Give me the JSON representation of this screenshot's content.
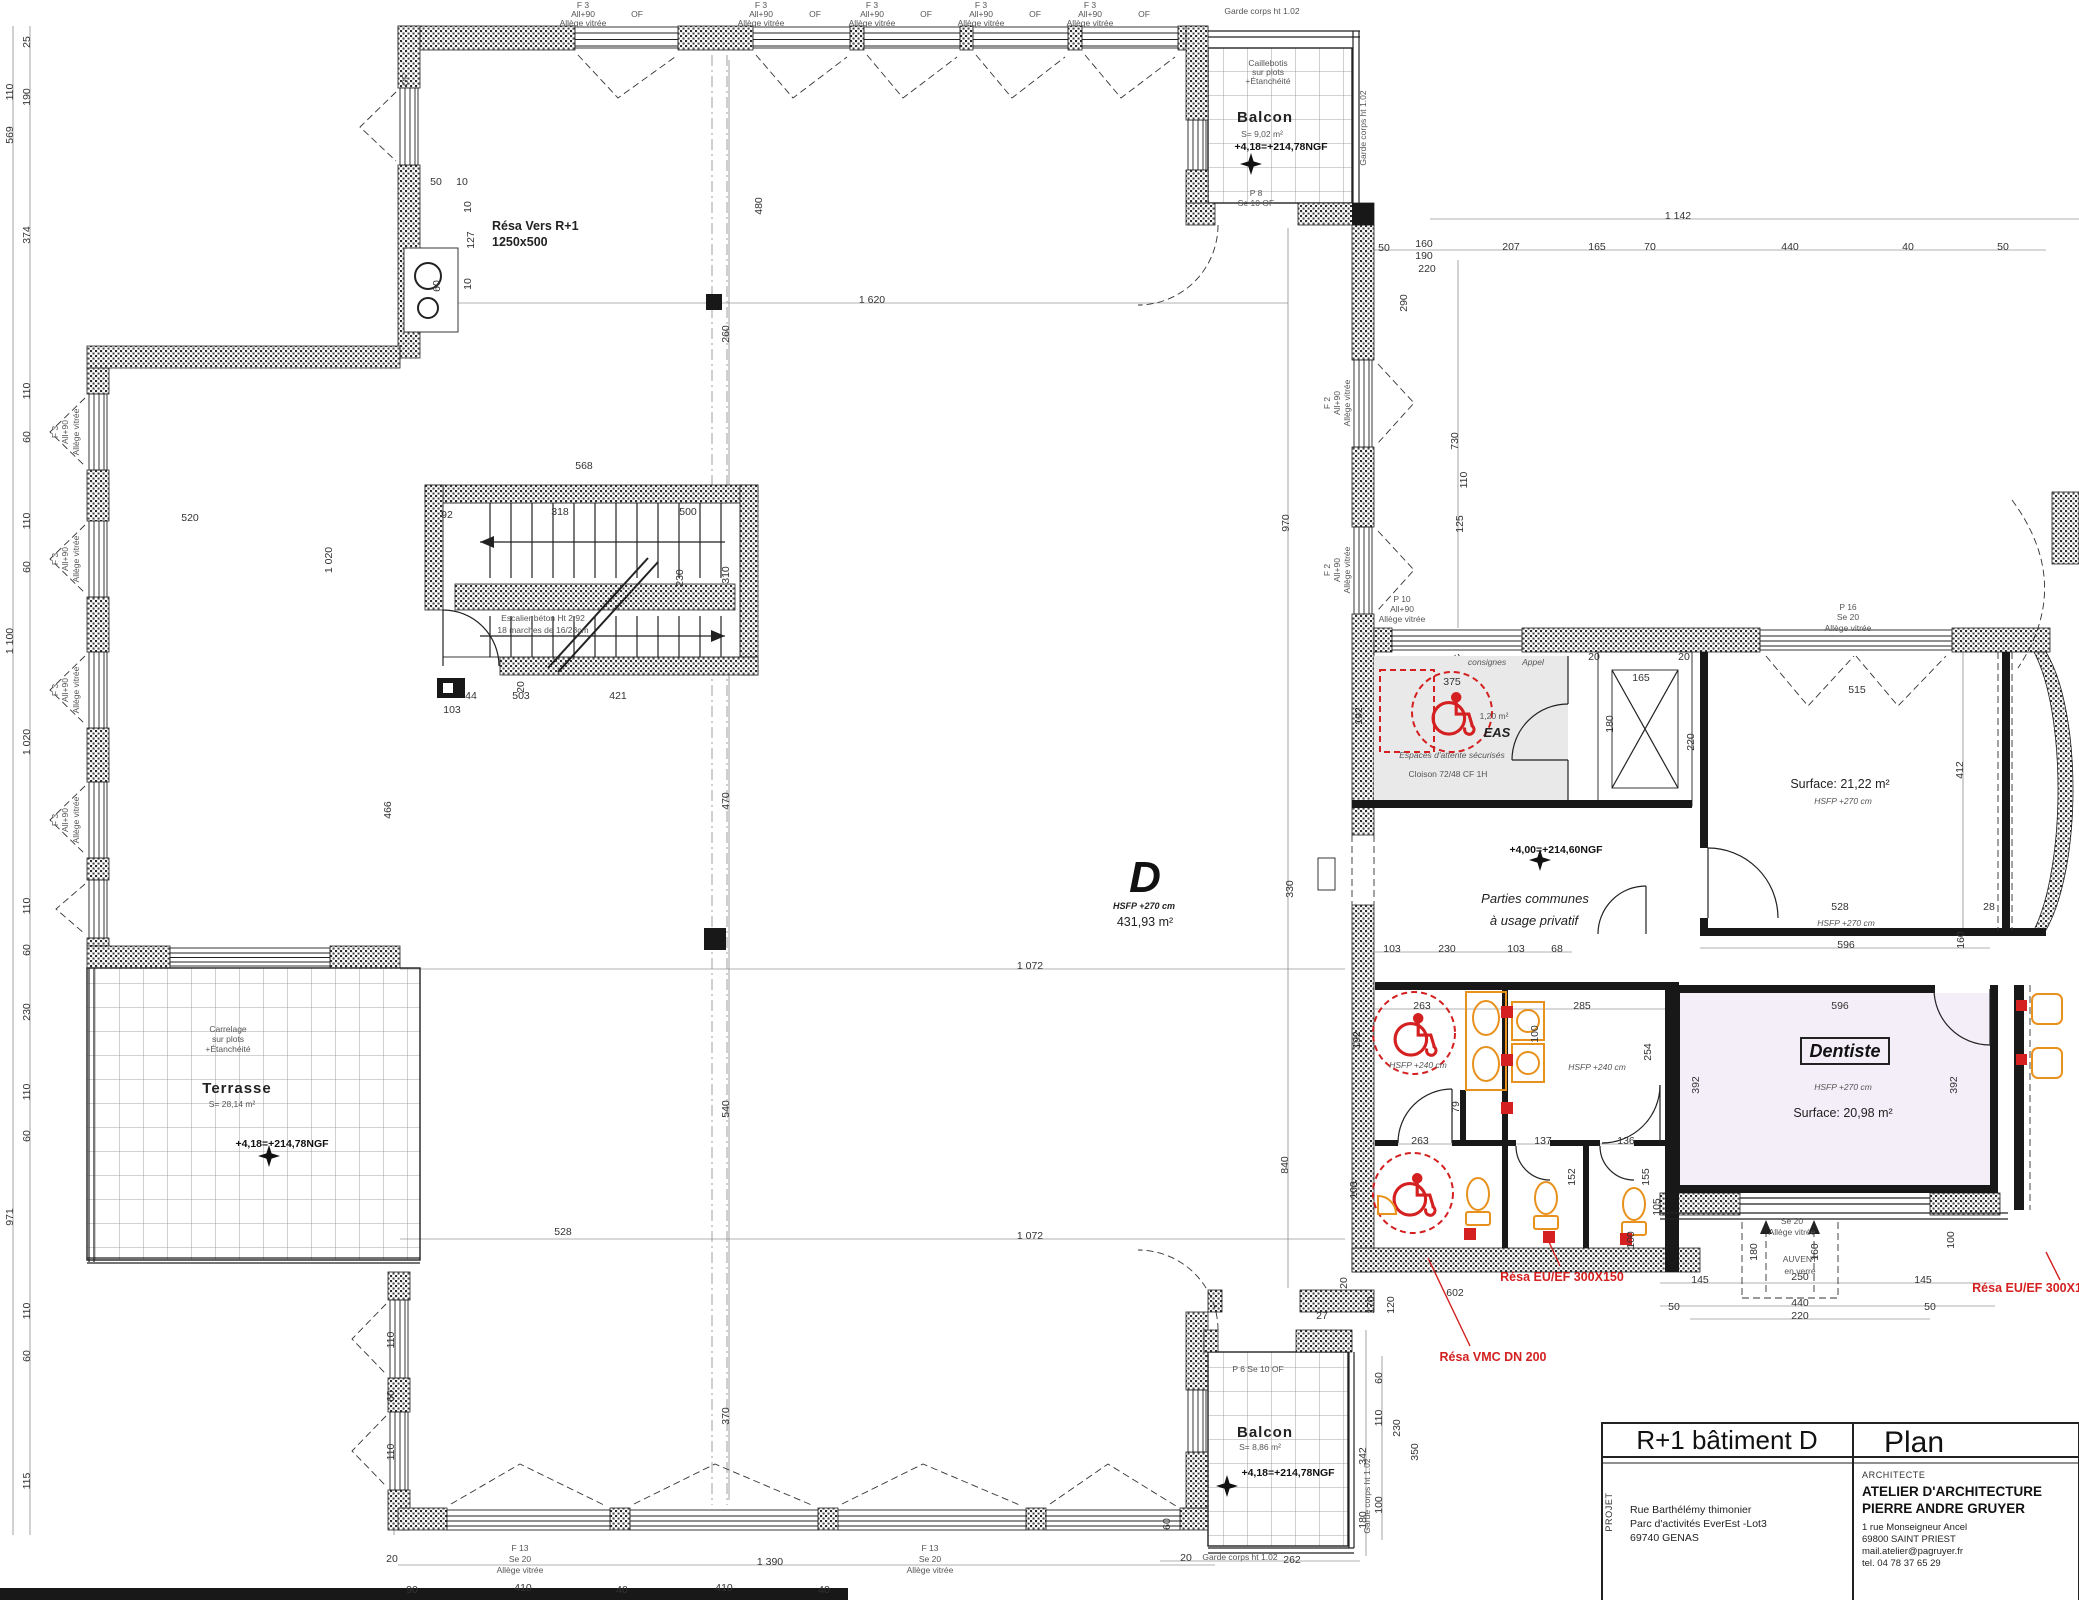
{
  "colors": {
    "red": "#d42020",
    "orange": "#e8921d",
    "dentiste_fill": "#f4eef8",
    "grey_fill": "#e9e9e9",
    "wall": "#181818"
  },
  "title_block": {
    "sheet_title": "R+1 bâtiment D",
    "sheet_type": "Plan",
    "projet_label": "PROJET",
    "projet_line1": "Rue Barthélémy thimonier",
    "projet_line2": "Parc d'activités EverEst -Lot3",
    "projet_line3": "69740 GENAS",
    "architecte_label": "ARCHITECTE",
    "architecte_name1": "ATELIER D'ARCHITECTURE",
    "architecte_name2": "PIERRE ANDRE GRUYER",
    "arch_line1": "1 rue Monseigneur Ancel",
    "arch_line2": "69800 SAINT PRIEST",
    "arch_line3": "mail.atelier@pagruyer.fr",
    "arch_line4": "tel. 04 78 37 65 29"
  },
  "plan": {
    "hall": {
      "letter": "D",
      "hsfp": "HSFP +270 cm",
      "area": "431,93 m²"
    },
    "parties1": "Parties communes",
    "parties2": "à usage privatif",
    "levels": {
      "main": "+4,00=+214,60NGF",
      "balcon_top": "+4,18=+214,78NGF",
      "balcon_bottom": "+4,18=+214,78NGF",
      "terrasse": "+4,18=+214,78NGF"
    },
    "rooms": {
      "dentiste": {
        "name": "Dentiste",
        "hsfp": "HSFP +270 cm",
        "surface": "Surface: 20,98 m²"
      },
      "s2122": {
        "surface": "Surface: 21,22 m²",
        "hsfp": "HSFP +270 cm"
      },
      "eas": {
        "name": "EAS",
        "area": "1,20 m²",
        "note": "Espaces d'attente sécurisés",
        "cloison": "Cloison 72/48 CF 1H",
        "consignes": "consignes",
        "appel": "Appel"
      },
      "balcon_top": {
        "name": "Balcon",
        "area": "S= 9,02 m²"
      },
      "balcon_bottom": {
        "name": "Balcon",
        "area": "S= 8,86 m²"
      },
      "terrasse": {
        "name": "Terrasse",
        "area": "S= 28,14 m²"
      }
    },
    "stair": {
      "line1": "Escalier béton Ht 2,92",
      "line2": "18 marches de 16/28cm"
    },
    "res": {
      "vers1": "Résa Vers R+1",
      "vers2": "1250x500",
      "eu_ef": "Résa EU/EF 300X150",
      "vmc": "Résa VMC DN 200",
      "eu_right": "Résa EU/EF 300X150"
    }
  },
  "annotations": [
    {
      "t": "1 620",
      "x": 872,
      "y": 303
    },
    {
      "t": "1 142",
      "x": 1678,
      "y": 219
    },
    {
      "t": "50",
      "x": 1384,
      "y": 251
    },
    {
      "t": "160",
      "x": 1424,
      "y": 247
    },
    {
      "t": "190",
      "x": 1424,
      "y": 259
    },
    {
      "t": "220",
      "x": 1427,
      "y": 272
    },
    {
      "t": "207",
      "x": 1511,
      "y": 250
    },
    {
      "t": "165",
      "x": 1597,
      "y": 250
    },
    {
      "t": "70",
      "x": 1650,
      "y": 250
    },
    {
      "t": "440",
      "x": 1790,
      "y": 250
    },
    {
      "t": "40",
      "x": 1908,
      "y": 250
    },
    {
      "t": "50",
      "x": 2003,
      "y": 250
    },
    {
      "t": "290",
      "x": 1407,
      "y": 303,
      "r": -90
    },
    {
      "t": "730",
      "x": 1458,
      "y": 441,
      "r": -90
    },
    {
      "t": "125",
      "x": 1463,
      "y": 524,
      "r": -90
    },
    {
      "t": "110",
      "x": 1467,
      "y": 480,
      "r": -90
    },
    {
      "t": "970",
      "x": 1289,
      "y": 523,
      "r": -90
    },
    {
      "t": "330",
      "x": 1293,
      "y": 889,
      "r": -90
    },
    {
      "t": "840",
      "x": 1288,
      "y": 1165,
      "r": -90
    },
    {
      "t": "480",
      "x": 762,
      "y": 206,
      "r": -90
    },
    {
      "t": "260",
      "x": 729,
      "y": 334,
      "r": -90
    },
    {
      "t": "310",
      "x": 729,
      "y": 575,
      "r": -90
    },
    {
      "t": "470",
      "x": 729,
      "y": 801,
      "r": -90
    },
    {
      "t": "540",
      "x": 729,
      "y": 1109,
      "r": -90
    },
    {
      "t": "370",
      "x": 729,
      "y": 1416,
      "r": -90
    },
    {
      "t": "1 072",
      "x": 1030,
      "y": 969
    },
    {
      "t": "1 072",
      "x": 1030,
      "y": 1239
    },
    {
      "t": "528",
      "x": 563,
      "y": 1235
    },
    {
      "t": "568",
      "x": 584,
      "y": 469
    },
    {
      "t": "92",
      "x": 447,
      "y": 518
    },
    {
      "t": "318",
      "x": 560,
      "y": 515
    },
    {
      "t": "500",
      "x": 688,
      "y": 515
    },
    {
      "t": "230",
      "x": 683,
      "y": 578,
      "r": -90
    },
    {
      "t": "20",
      "x": 524,
      "y": 687,
      "r": -90
    },
    {
      "t": "44",
      "x": 471,
      "y": 699
    },
    {
      "t": "503",
      "x": 521,
      "y": 699
    },
    {
      "t": "421",
      "x": 618,
      "y": 699
    },
    {
      "t": "103",
      "x": 452,
      "y": 713
    },
    {
      "t": "520",
      "x": 190,
      "y": 521
    },
    {
      "t": "1 020",
      "x": 332,
      "y": 560,
      "r": -90
    },
    {
      "t": "466",
      "x": 391,
      "y": 810,
      "r": -90
    },
    {
      "t": "50",
      "x": 436,
      "y": 185
    },
    {
      "t": "10",
      "x": 462,
      "y": 185
    },
    {
      "t": "127",
      "x": 474,
      "y": 240,
      "r": -90
    },
    {
      "t": "10",
      "x": 471,
      "y": 207,
      "r": -90
    },
    {
      "t": "10",
      "x": 471,
      "y": 284,
      "r": -90
    },
    {
      "t": "60",
      "x": 440,
      "y": 286,
      "r": -90
    },
    {
      "t": "25",
      "x": 30,
      "y": 42,
      "r": -90
    },
    {
      "t": "110",
      "x": 13,
      "y": 92,
      "r": -90
    },
    {
      "t": "190",
      "x": 30,
      "y": 97,
      "r": -90
    },
    {
      "t": "569",
      "x": 13,
      "y": 135,
      "r": -90
    },
    {
      "t": "374",
      "x": 30,
      "y": 235,
      "r": -90
    },
    {
      "t": "110",
      "x": 30,
      "y": 391,
      "r": -90
    },
    {
      "t": "60",
      "x": 30,
      "y": 437,
      "r": -90
    },
    {
      "t": "110",
      "x": 30,
      "y": 521,
      "r": -90
    },
    {
      "t": "60",
      "x": 30,
      "y": 567,
      "r": -90
    },
    {
      "t": "1 100",
      "x": 13,
      "y": 641,
      "r": -90
    },
    {
      "t": "1 020",
      "x": 30,
      "y": 742,
      "r": -90
    },
    {
      "t": "110",
      "x": 30,
      "y": 906,
      "r": -90
    },
    {
      "t": "60",
      "x": 30,
      "y": 950,
      "r": -90
    },
    {
      "t": "230",
      "x": 30,
      "y": 1012,
      "r": -90
    },
    {
      "t": "110",
      "x": 30,
      "y": 1092,
      "r": -90
    },
    {
      "t": "60",
      "x": 30,
      "y": 1136,
      "r": -90
    },
    {
      "t": "971",
      "x": 13,
      "y": 1217,
      "r": -90
    },
    {
      "t": "110",
      "x": 30,
      "y": 1311,
      "r": -90
    },
    {
      "t": "60",
      "x": 30,
      "y": 1356,
      "r": -90
    },
    {
      "t": "115",
      "x": 30,
      "y": 1481,
      "r": -90
    },
    {
      "t": "103",
      "x": 1392,
      "y": 952
    },
    {
      "t": "230",
      "x": 1447,
      "y": 952
    },
    {
      "t": "103",
      "x": 1516,
      "y": 952
    },
    {
      "t": "68",
      "x": 1557,
      "y": 952
    },
    {
      "t": "375",
      "x": 1452,
      "y": 685
    },
    {
      "t": "165",
      "x": 1641,
      "y": 681
    },
    {
      "t": "180",
      "x": 1613,
      "y": 724,
      "r": -90
    },
    {
      "t": "20",
      "x": 1594,
      "y": 660
    },
    {
      "t": "20",
      "x": 1684,
      "y": 660
    },
    {
      "t": "515",
      "x": 1857,
      "y": 693
    },
    {
      "t": "412",
      "x": 1963,
      "y": 770,
      "r": -90
    },
    {
      "t": "220",
      "x": 1694,
      "y": 742,
      "r": -90
    },
    {
      "t": "528",
      "x": 1840,
      "y": 910
    },
    {
      "t": "28",
      "x": 1989,
      "y": 910
    },
    {
      "t": "HSFP +270 cm",
      "x": 1846,
      "y": 926,
      "c": "tinyi"
    },
    {
      "t": "596",
      "x": 1846,
      "y": 948
    },
    {
      "t": "160",
      "x": 1964,
      "y": 940,
      "r": -90
    },
    {
      "t": "596",
      "x": 1840,
      "y": 1009
    },
    {
      "t": "392",
      "x": 1699,
      "y": 1085,
      "r": -90
    },
    {
      "t": "392",
      "x": 1957,
      "y": 1085,
      "r": -90
    },
    {
      "t": "263",
      "x": 1422,
      "y": 1009
    },
    {
      "t": "285",
      "x": 1582,
      "y": 1009
    },
    {
      "t": "263",
      "x": 1420,
      "y": 1144
    },
    {
      "t": "137",
      "x": 1543,
      "y": 1144
    },
    {
      "t": "136",
      "x": 1626,
      "y": 1144
    },
    {
      "t": "79",
      "x": 1459,
      "y": 1107,
      "r": -90
    },
    {
      "t": "100",
      "x": 1538,
      "y": 1034,
      "r": -90
    },
    {
      "t": "152",
      "x": 1575,
      "y": 1177,
      "r": -90
    },
    {
      "t": "155",
      "x": 1649,
      "y": 1177,
      "r": -90
    },
    {
      "t": "105",
      "x": 1660,
      "y": 1207,
      "r": -90
    },
    {
      "t": "100",
      "x": 1357,
      "y": 1190,
      "r": -90
    },
    {
      "t": "192",
      "x": 1360,
      "y": 1040,
      "r": -90
    },
    {
      "t": "192",
      "x": 1362,
      "y": 716,
      "r": -90
    },
    {
      "t": "254",
      "x": 1651,
      "y": 1052,
      "r": -90
    },
    {
      "t": "602",
      "x": 1455,
      "y": 1296
    },
    {
      "t": "170",
      "x": 1374,
      "y": 1305,
      "r": -90
    },
    {
      "t": "120",
      "x": 1394,
      "y": 1305,
      "r": -90
    },
    {
      "t": "20",
      "x": 1347,
      "y": 1283,
      "r": -90
    },
    {
      "t": "27",
      "x": 1322,
      "y": 1319
    },
    {
      "t": "145",
      "x": 1700,
      "y": 1283
    },
    {
      "t": "250",
      "x": 1800,
      "y": 1280
    },
    {
      "t": "145",
      "x": 1923,
      "y": 1283
    },
    {
      "t": "50",
      "x": 1674,
      "y": 1310
    },
    {
      "t": "440",
      "x": 1800,
      "y": 1306
    },
    {
      "t": "50",
      "x": 1930,
      "y": 1310
    },
    {
      "t": "220",
      "x": 1800,
      "y": 1319
    },
    {
      "t": "100",
      "x": 1634,
      "y": 1240,
      "r": -90
    },
    {
      "t": "100",
      "x": 1954,
      "y": 1240,
      "r": -90
    },
    {
      "t": "180",
      "x": 1757,
      "y": 1252,
      "r": -90
    },
    {
      "t": "160",
      "x": 1818,
      "y": 1252,
      "r": -90
    },
    {
      "t": "60",
      "x": 1382,
      "y": 1378,
      "r": -90
    },
    {
      "t": "110",
      "x": 1382,
      "y": 1418,
      "r": -90
    },
    {
      "t": "230",
      "x": 1400,
      "y": 1428,
      "r": -90
    },
    {
      "t": "342",
      "x": 1366,
      "y": 1456,
      "r": -90
    },
    {
      "t": "350",
      "x": 1418,
      "y": 1452,
      "r": -90
    },
    {
      "t": "100",
      "x": 1382,
      "y": 1505,
      "r": -90
    },
    {
      "t": "180",
      "x": 1366,
      "y": 1520,
      "r": -90
    },
    {
      "t": "60",
      "x": 1170,
      "y": 1524,
      "r": -90
    },
    {
      "t": "262",
      "x": 1292,
      "y": 1563
    },
    {
      "t": "20",
      "x": 1186,
      "y": 1561
    },
    {
      "t": "1 390",
      "x": 770,
      "y": 1565
    },
    {
      "t": "20",
      "x": 392,
      "y": 1562
    },
    {
      "t": "90",
      "x": 412,
      "y": 1593
    },
    {
      "t": "410",
      "x": 523,
      "y": 1591
    },
    {
      "t": "40",
      "x": 622,
      "y": 1593
    },
    {
      "t": "410",
      "x": 724,
      "y": 1591
    },
    {
      "t": "40",
      "x": 824,
      "y": 1593
    },
    {
      "t": "110",
      "x": 394,
      "y": 1340,
      "r": -90
    },
    {
      "t": "60",
      "x": 394,
      "y": 1396,
      "r": -90
    },
    {
      "t": "110",
      "x": 394,
      "y": 1452,
      "r": -90
    },
    {
      "t": "Garde corps ht 1.02",
      "x": 1262,
      "y": 14,
      "c": "tiny"
    },
    {
      "t": "Garde corps ht 1.02",
      "x": 1366,
      "y": 128,
      "r": -90,
      "c": "tiny"
    },
    {
      "t": "Garde corps ht 1.02",
      "x": 1240,
      "y": 1560,
      "c": "tiny"
    },
    {
      "t": "Garde corps ht 1.02",
      "x": 1370,
      "y": 1496,
      "r": -90,
      "c": "tiny"
    },
    {
      "t": "Caillebotis",
      "x": 1268,
      "y": 66,
      "c": "tiny"
    },
    {
      "t": "sur plots",
      "x": 1268,
      "y": 75,
      "c": "tiny"
    },
    {
      "t": "+Étanchéité",
      "x": 1268,
      "y": 84,
      "c": "tiny"
    },
    {
      "t": "Carrelage",
      "x": 228,
      "y": 1032,
      "c": "tiny"
    },
    {
      "t": "sur plots",
      "x": 228,
      "y": 1042,
      "c": "tiny"
    },
    {
      "t": "+Étanchéité",
      "x": 228,
      "y": 1052,
      "c": "tiny"
    },
    {
      "t": "P 8",
      "x": 1256,
      "y": 196,
      "c": "tiny"
    },
    {
      "t": "Se 10  OF",
      "x": 1256,
      "y": 206,
      "c": "tiny"
    },
    {
      "t": "P 6  Se 10  OF",
      "x": 1258,
      "y": 1372,
      "c": "tiny"
    },
    {
      "t": "OF",
      "x": 408,
      "y": 80,
      "r": -90,
      "c": "tiny"
    },
    {
      "t": "HSFP +240 cm",
      "x": 1418,
      "y": 1068,
      "c": "tinyi"
    },
    {
      "t": "HSFP +240 cm",
      "x": 1597,
      "y": 1070,
      "c": "tinyi"
    },
    {
      "t": "F 3",
      "x": 583,
      "y": 8,
      "a": "s",
      "c": "tiny"
    },
    {
      "t": "All+90",
      "x": 583,
      "y": 17,
      "a": "s",
      "c": "tiny"
    },
    {
      "t": "OF",
      "x": 637,
      "y": 17,
      "a": "s",
      "c": "tiny"
    },
    {
      "t": "Allège vitrée",
      "x": 583,
      "y": 26,
      "a": "s",
      "c": "tiny"
    },
    {
      "t": "F 3",
      "x": 761,
      "y": 8,
      "a": "s",
      "c": "tiny"
    },
    {
      "t": "All+90",
      "x": 761,
      "y": 17,
      "a": "s",
      "c": "tiny"
    },
    {
      "t": "OF",
      "x": 815,
      "y": 17,
      "a": "s",
      "c": "tiny"
    },
    {
      "t": "Allège vitrée",
      "x": 761,
      "y": 26,
      "a": "s",
      "c": "tiny"
    },
    {
      "t": "F 3",
      "x": 872,
      "y": 8,
      "a": "s",
      "c": "tiny"
    },
    {
      "t": "All+90",
      "x": 872,
      "y": 17,
      "a": "s",
      "c": "tiny"
    },
    {
      "t": "OF",
      "x": 926,
      "y": 17,
      "a": "s",
      "c": "tiny"
    },
    {
      "t": "Allège vitrée",
      "x": 872,
      "y": 26,
      "a": "s",
      "c": "tiny"
    },
    {
      "t": "F 3",
      "x": 981,
      "y": 8,
      "a": "s",
      "c": "tiny"
    },
    {
      "t": "All+90",
      "x": 981,
      "y": 17,
      "a": "s",
      "c": "tiny"
    },
    {
      "t": "OF",
      "x": 1035,
      "y": 17,
      "a": "s",
      "c": "tiny"
    },
    {
      "t": "Allège vitrée",
      "x": 981,
      "y": 26,
      "a": "s",
      "c": "tiny"
    },
    {
      "t": "F 3",
      "x": 1090,
      "y": 8,
      "a": "s",
      "c": "tiny"
    },
    {
      "t": "All+90",
      "x": 1090,
      "y": 17,
      "a": "s",
      "c": "tiny"
    },
    {
      "t": "OF",
      "x": 1144,
      "y": 17,
      "a": "s",
      "c": "tiny"
    },
    {
      "t": "Allège vitrée",
      "x": 1090,
      "y": 26,
      "a": "s",
      "c": "tiny"
    },
    {
      "t": "F 3",
      "x": 58,
      "y": 432,
      "r": -90,
      "c": "tiny"
    },
    {
      "t": "All+90",
      "x": 68,
      "y": 432,
      "r": -90,
      "c": "tiny"
    },
    {
      "t": "Allège vitrée",
      "x": 79,
      "y": 432,
      "r": -90,
      "c": "tiny"
    },
    {
      "t": "F 3",
      "x": 58,
      "y": 559,
      "r": -90,
      "c": "tiny"
    },
    {
      "t": "All+90",
      "x": 68,
      "y": 559,
      "r": -90,
      "c": "tiny"
    },
    {
      "t": "Allège vitrée",
      "x": 79,
      "y": 559,
      "r": -90,
      "c": "tiny"
    },
    {
      "t": "F 3",
      "x": 58,
      "y": 690,
      "r": -90,
      "c": "tiny"
    },
    {
      "t": "All+90",
      "x": 68,
      "y": 690,
      "r": -90,
      "c": "tiny"
    },
    {
      "t": "Allège vitrée",
      "x": 79,
      "y": 690,
      "r": -90,
      "c": "tiny"
    },
    {
      "t": "F 3",
      "x": 58,
      "y": 820,
      "r": -90,
      "c": "tiny"
    },
    {
      "t": "All+90",
      "x": 68,
      "y": 820,
      "r": -90,
      "c": "tiny"
    },
    {
      "t": "Allège vitrée",
      "x": 79,
      "y": 820,
      "r": -90,
      "c": "tiny"
    },
    {
      "t": "F 2",
      "x": 1330,
      "y": 403,
      "r": -90,
      "c": "tiny"
    },
    {
      "t": "All+90",
      "x": 1340,
      "y": 403,
      "r": -90,
      "c": "tiny"
    },
    {
      "t": "Allège vitrée",
      "x": 1350,
      "y": 403,
      "r": -90,
      "c": "tiny"
    },
    {
      "t": "F 2",
      "x": 1330,
      "y": 570,
      "r": -90,
      "c": "tiny"
    },
    {
      "t": "All+90",
      "x": 1340,
      "y": 570,
      "r": -90,
      "c": "tiny"
    },
    {
      "t": "Allège vitrée",
      "x": 1350,
      "y": 570,
      "r": -90,
      "c": "tiny"
    },
    {
      "t": "F 13",
      "x": 520,
      "y": 1551,
      "c": "tiny"
    },
    {
      "t": "Se 20",
      "x": 520,
      "y": 1562,
      "c": "tiny"
    },
    {
      "t": "Allège vitrée",
      "x": 520,
      "y": 1573,
      "c": "tiny"
    },
    {
      "t": "F 13",
      "x": 930,
      "y": 1551,
      "c": "tiny"
    },
    {
      "t": "Se 20",
      "x": 930,
      "y": 1562,
      "c": "tiny"
    },
    {
      "t": "Allège vitrée",
      "x": 930,
      "y": 1573,
      "c": "tiny"
    },
    {
      "t": "P 10",
      "x": 1402,
      "y": 602,
      "a": "s",
      "c": "tiny"
    },
    {
      "t": "All+90",
      "x": 1402,
      "y": 612,
      "a": "s",
      "c": "tiny"
    },
    {
      "t": "Allège vitrée",
      "x": 1402,
      "y": 622,
      "a": "s",
      "c": "tiny"
    },
    {
      "t": "P 16",
      "x": 1848,
      "y": 610,
      "c": "tiny"
    },
    {
      "t": "Se 20",
      "x": 1848,
      "y": 620,
      "c": "tiny"
    },
    {
      "t": "Allège vitrée",
      "x": 1848,
      "y": 631,
      "c": "tiny"
    },
    {
      "t": "Se 20",
      "x": 1792,
      "y": 1224,
      "c": "tiny"
    },
    {
      "t": "Allège vitrée",
      "x": 1792,
      "y": 1235,
      "c": "tiny"
    },
    {
      "t": "AUVENT",
      "x": 1800,
      "y": 1262,
      "c": "tiny"
    },
    {
      "t": "en verre",
      "x": 1800,
      "y": 1274,
      "c": "tiny"
    }
  ]
}
